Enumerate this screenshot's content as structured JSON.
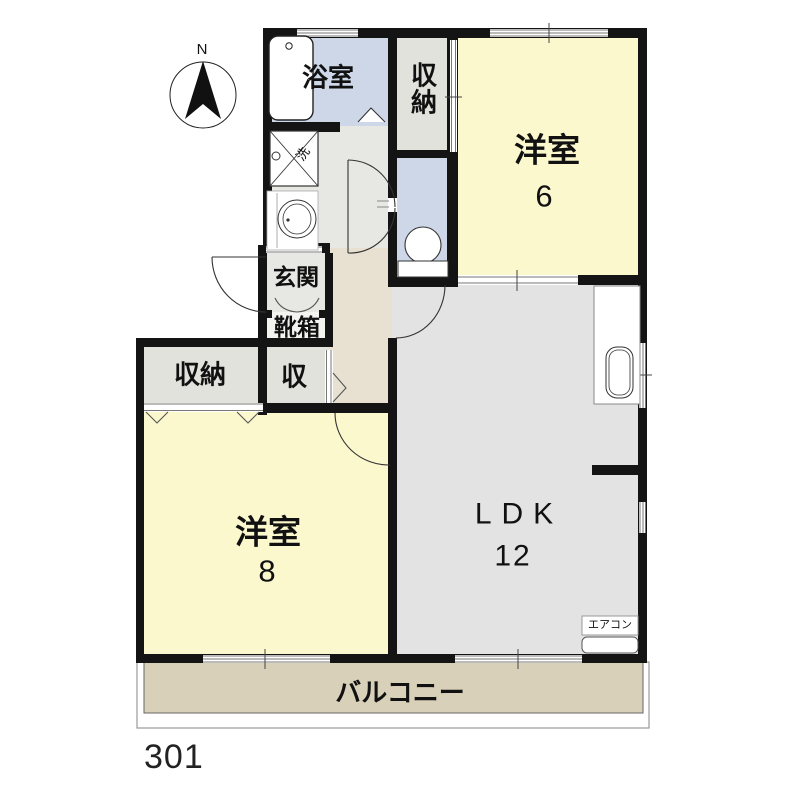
{
  "unit": {
    "number": "301"
  },
  "compass": {
    "label": "N"
  },
  "rooms": {
    "bath": {
      "label": "浴室"
    },
    "closet_top": {
      "label": "収納"
    },
    "western6": {
      "label": "洋室",
      "size": "6"
    },
    "entrance": {
      "label": "玄関"
    },
    "shoebox": {
      "label": "靴箱"
    },
    "closet_small": {
      "label": "収"
    },
    "closet_left": {
      "label": "収納"
    },
    "western8": {
      "label": "洋室",
      "size": "8"
    },
    "ldk": {
      "label": "LDK",
      "size": "12"
    },
    "balcony": {
      "label": "バルコニー"
    }
  },
  "fixtures": {
    "washer_pan": {
      "label": "洗"
    },
    "aircon": {
      "label": "エアコン"
    }
  },
  "colors": {
    "wall": "#141414",
    "tatami_yellow": "#fbf8cd",
    "water_blue": "#cdd7e8",
    "floor_gray": "#e7e7e3",
    "ldk_gray": "#e3e3e3",
    "closet_gray": "#e2e2dc",
    "hallway_beige": "#e8e1d1",
    "shoebox_white": "#f3f3f0",
    "balcony_tan": "#d8d0b8"
  }
}
